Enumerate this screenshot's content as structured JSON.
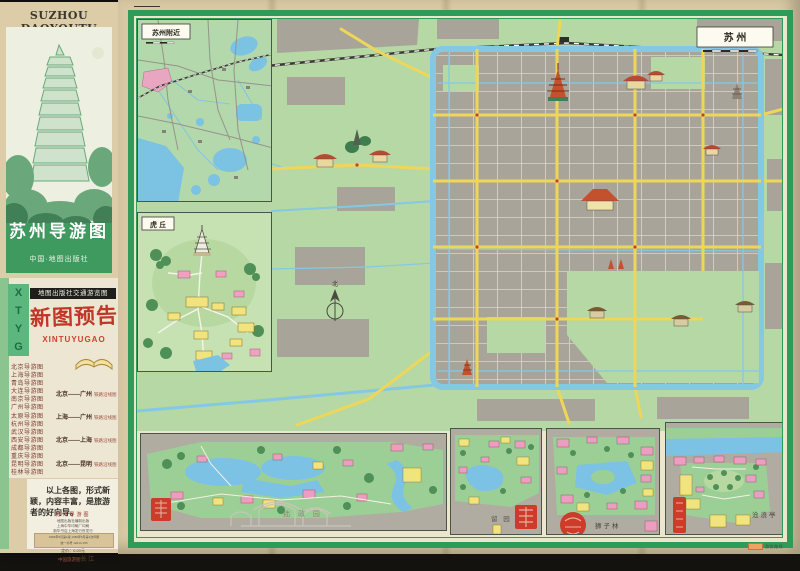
{
  "cover": {
    "masthead": "SUZHOU DAOYOUTU",
    "title": "苏州导游图",
    "publisher": "中国·地图出版社",
    "promo": {
      "side_letters": [
        "X",
        "T",
        "Y",
        "G"
      ],
      "header": "地图出版社交通游览图",
      "script_title": "新图预告",
      "script_latin": "XINTUYUGAO",
      "city_guides": [
        "北京导游图",
        "上海导游图",
        "青岛导游图",
        "大连导游图",
        "南京导游图",
        "广州导游图",
        "太原导游图",
        "杭州导游图",
        "武汉导游图",
        "西安导游图",
        "成都导游图",
        "重庆导游图",
        "昆明导游图",
        "桂林导游图"
      ],
      "route_maps": [
        {
          "route": "北京——广州",
          "suffix": "铁路沿线图"
        },
        {
          "route": "上海——广州",
          "suffix": "铁路沿线图"
        },
        {
          "route": "北京——上海",
          "suffix": "铁路沿线图"
        },
        {
          "route": "北京——昆明",
          "suffix": "铁路沿线图"
        },
        {
          "route": "北戴河游览图",
          "suffix": "承德游览图"
        },
        {
          "route": "拉萨游览图",
          "suffix": "（汉英文版）"
        },
        {
          "route": "中国旅游图",
          "suffix": "广东  广西"
        },
        {
          "route": "中国旅游图",
          "suffix": "长  江"
        }
      ],
      "slogan": "以上各图，形式新颖，内容丰富，是旅游者的好向导。"
    },
    "imprint": {
      "title": "苏州导游图",
      "lines": [
        "地图出版社编制出版",
        "上海中华印刷厂印刷",
        "新华书店上海发行所发行"
      ],
      "box_lines": [
        "1982年5月第1版  1982年5月第1次印刷",
        "统一书号 12014·155"
      ],
      "price_line": "定价：0.20元"
    }
  },
  "map": {
    "city_label": "苏  州",
    "compass_north": "北",
    "insets": {
      "vicinity": "苏州附近",
      "huqiu": "虎 丘",
      "zhuozhengyuan": "拙 政 园",
      "liuyuan": "留  园",
      "shizilin": "狮子林",
      "canglangting": "沧浪亭"
    },
    "legend_label": "游览路线",
    "colors": {
      "frame_green": "#2f9b58",
      "road_yellow": "#eed65a",
      "water_blue": "#84c8e4",
      "land_green": "#b6d8a4",
      "city_gray": "#a8a499",
      "building_pink": "#ec9ec0",
      "building_yellow": "#f1e47e",
      "seal_red": "#cd3c2a",
      "paper_tan": "#d8c9a4"
    }
  }
}
